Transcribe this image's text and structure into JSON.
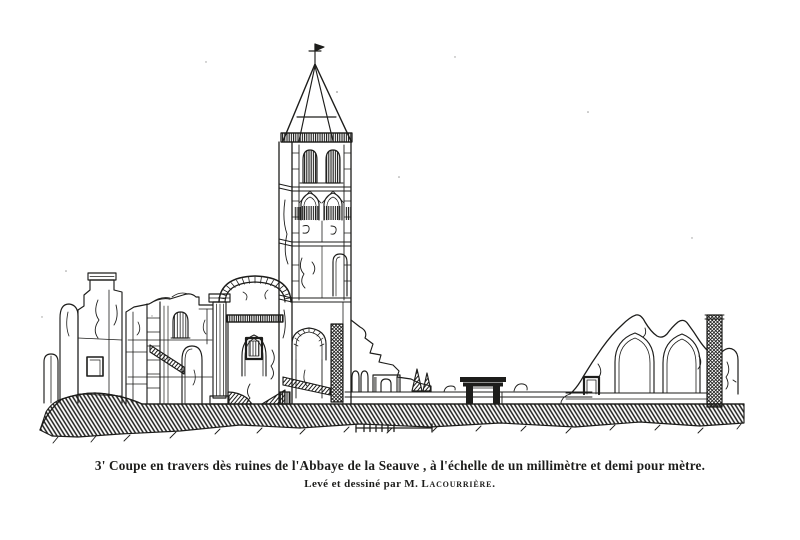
{
  "colors": {
    "ink": "#1d1d1b",
    "paper": "#ffffff"
  },
  "figure": {
    "alt": "Engraved transverse section of abbey ruins: ruined walls at left, a great round arch, a tall central bell tower with octagonal spire and cross finial, low boundary wall with a small portal, a gable wall pierced by two pointed arches, and a tall masonry pillar at right, all standing on a hatched ground line with a graphic scale bar below."
  },
  "caption": {
    "line1": "3' Coupe en travers dès ruines de l'Abbaye de la Seauve , à l'échelle de un millimètre et demi pour mètre.",
    "line2_prefix": "Levé et dessiné par M.",
    "line2_name": "Lacourrière."
  }
}
